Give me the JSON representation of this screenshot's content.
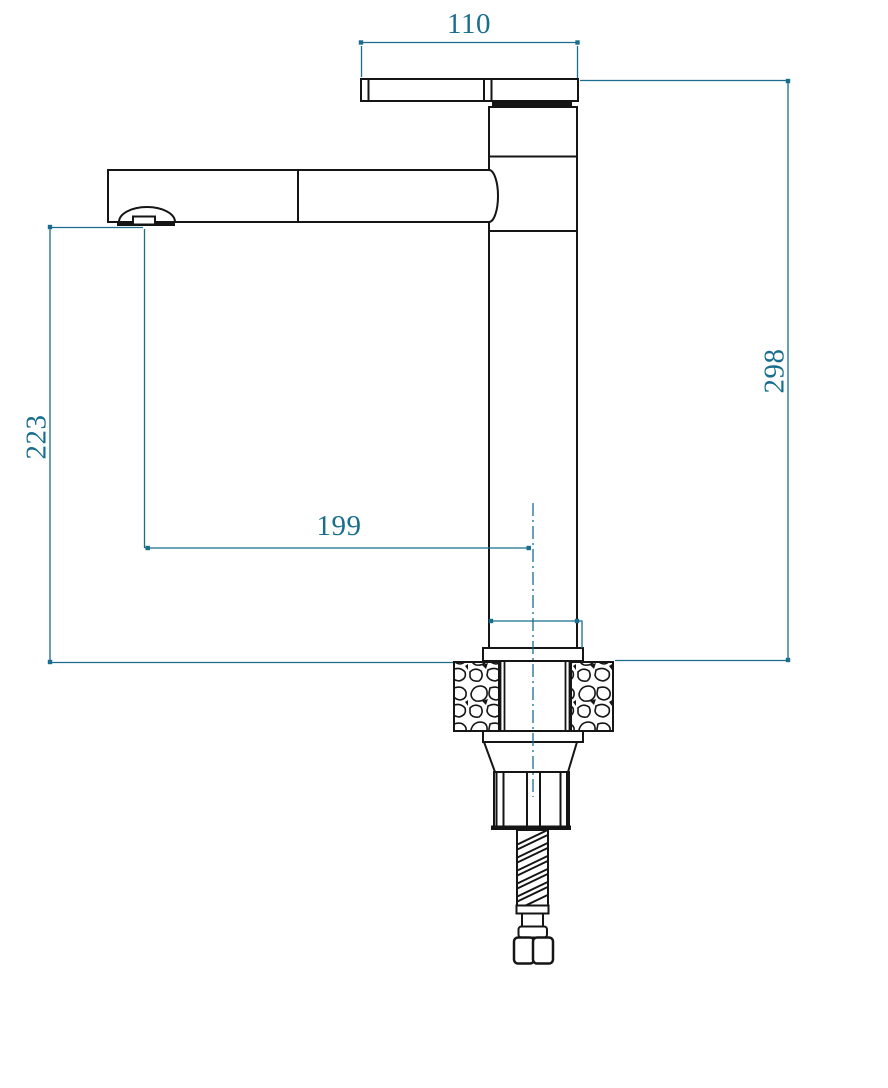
{
  "drawing": {
    "kind": "faucet-dimension-drawing",
    "labels": {
      "spout_top_width": "110",
      "overall_height": "298",
      "spout_outlet_height": "223",
      "spout_reach": "199"
    },
    "colors": {
      "dimension_accent": "#186e8c",
      "outline": "#151515",
      "background": "#ffffff"
    }
  }
}
